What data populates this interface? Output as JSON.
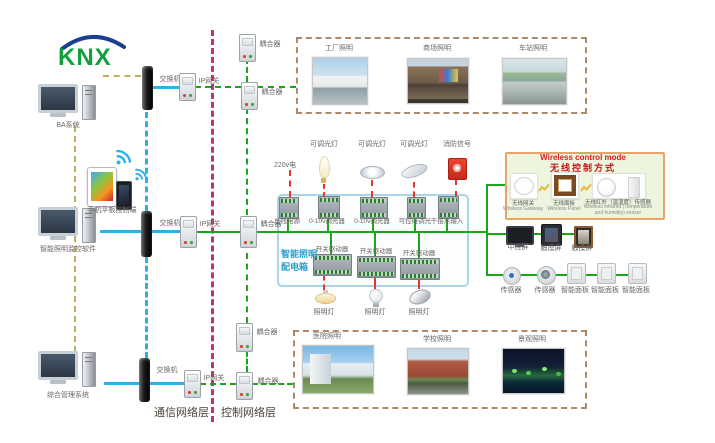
{
  "logo": {
    "text": "KNX"
  },
  "left": {
    "computers": [
      {
        "label": "BA系统"
      },
      {
        "label": "智能照明监控软件"
      },
      {
        "label": "综合管理系统"
      }
    ],
    "mobile": {
      "label": "手机平板控制端"
    }
  },
  "comm": {
    "switches": [
      "交换机",
      "交换机",
      "交换机"
    ],
    "gateways": [
      "IP网关",
      "IP网关",
      "IP网关"
    ],
    "couplers": [
      "耦合器",
      "耦合器",
      "耦合器",
      "耦合器",
      "耦合器"
    ]
  },
  "layers": {
    "communication": "通信网络层",
    "control": "控制网络层"
  },
  "scenes_top": [
    {
      "label": "工厂照明"
    },
    {
      "label": "商场照明"
    },
    {
      "label": "车站照明"
    }
  ],
  "scenes_bottom": [
    {
      "label": "医院照明"
    },
    {
      "label": "学校照明"
    },
    {
      "label": "景观照明"
    }
  ],
  "panel": {
    "title1": "智能照明",
    "title2": "配电箱",
    "power": "220v电",
    "inputs": [
      "可调光灯",
      "可调光灯",
      "可调光灯",
      "消防信号"
    ],
    "top_devices": [
      "总线电源",
      "0-10v调光器",
      "0-10v调光器",
      "可控硅调光",
      "干接点输入"
    ],
    "drivers": [
      "开关驱动器",
      "开关驱动器",
      "开关驱动器"
    ],
    "lamps": [
      "照明灯",
      "照明灯",
      "照明灯"
    ]
  },
  "wireless": {
    "title_en": "Wireless control mode",
    "title_zh": "无线控制方式",
    "items": [
      {
        "zh": "无线网关",
        "en": "Wireless Gateway"
      },
      {
        "zh": "无线面板",
        "en": "Wireless Panel"
      },
      {
        "zh": "无线红外（温湿度）传感器",
        "en": "Wireless infrared (Temperature and humidity) sensor"
      }
    ]
  },
  "right_devices": {
    "screens": [
      "中控屏",
      "触摸屏",
      "触摸屏"
    ],
    "sensors": [
      "传感器",
      "传感器"
    ],
    "panels": [
      "智能面板",
      "智能面板",
      "智能面板"
    ]
  },
  "colors": {
    "green_bus": "#1ca41c",
    "blue_link": "#2bb0e8",
    "khaki_link": "#c2ae62",
    "layer_divider": "#bf2f7b",
    "red_power": "#e8372a",
    "panel_border": "#a8d6e8",
    "panel_title": "#2a9fd0",
    "wireless_bg": "#edf5de",
    "wireless_border": "#e6a36c",
    "wireless_title": "#cc1111",
    "knx_green": "#12a03c",
    "knx_blue": "#1b3f8f",
    "frame_dash": "#b08968"
  }
}
